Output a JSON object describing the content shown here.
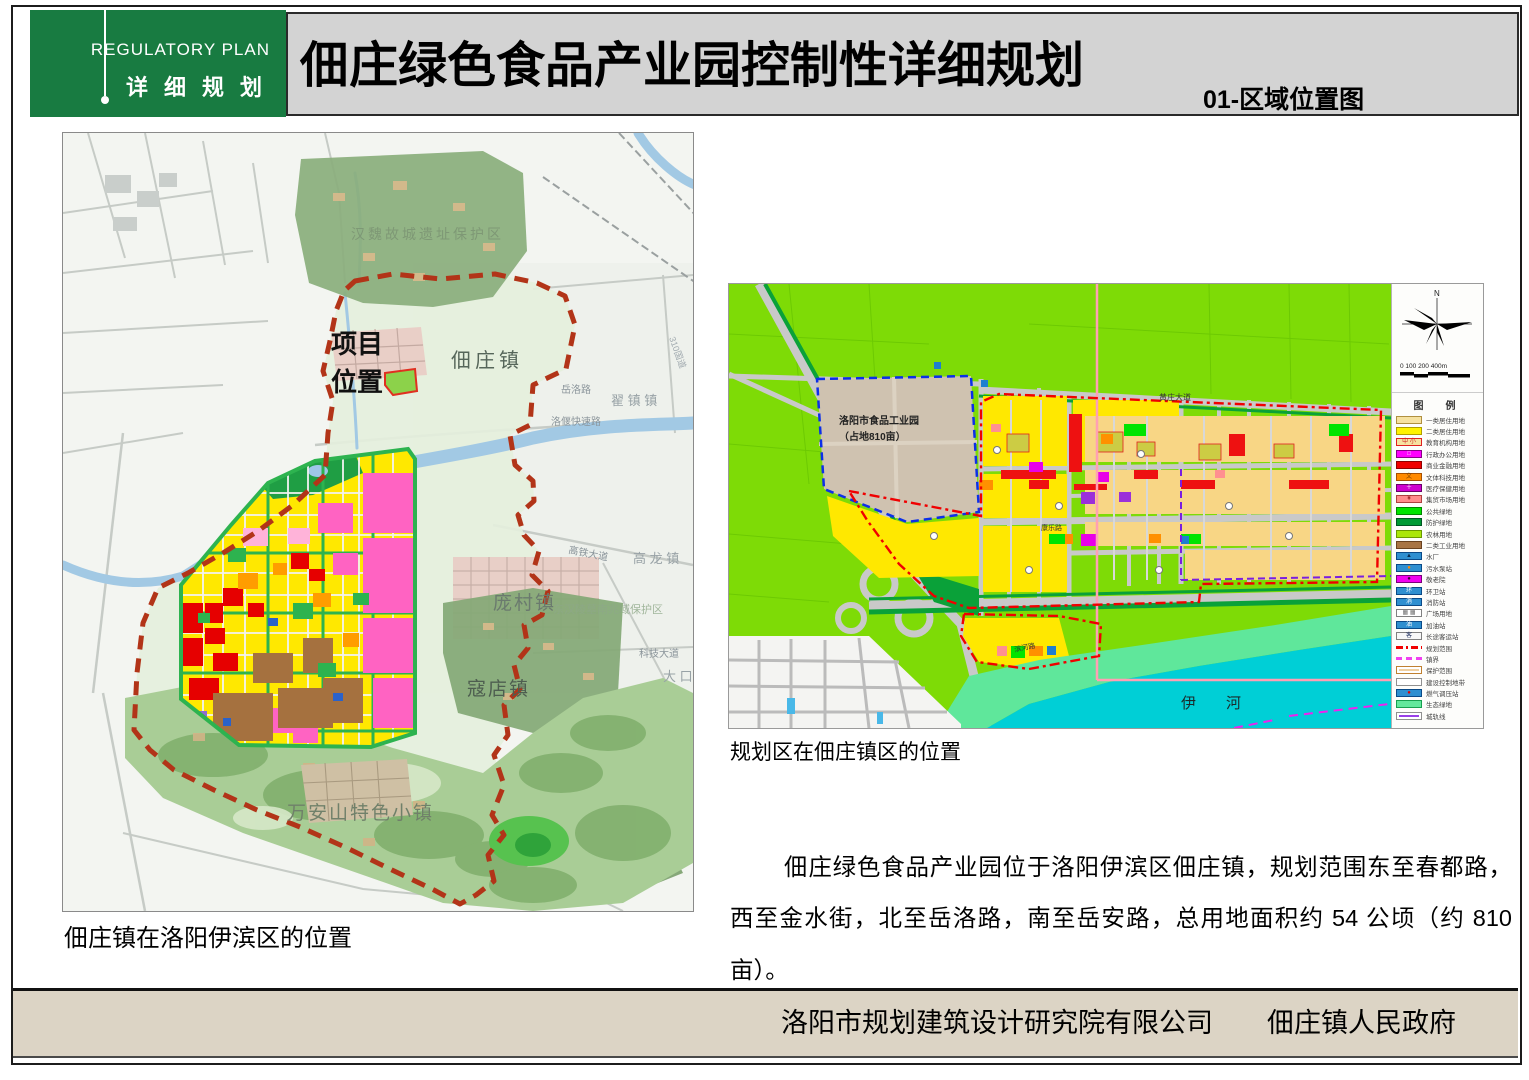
{
  "header": {
    "brand": {
      "line_en": "REGULATORY PLAN",
      "line_zh": "详细规划"
    },
    "title": "佃庄绿色食品产业园控制性详细规划",
    "sheet_label": "01-区域位置图"
  },
  "left_map": {
    "caption": "佃庄镇在洛阳伊滨区的位置",
    "labels": {
      "project_line1": "项目",
      "project_line2": "位置",
      "dianzhuang_town": "佃庄镇",
      "hanwei_reserve": "汉魏故城遗址保护区",
      "zhaizhen_town": "翟 镇 镇",
      "pangcun_town": "庞村镇",
      "gaolong_town": "高 龙 镇",
      "dakou_town": "大 口 镇",
      "koudian_town": "寇店镇",
      "yan": "偃",
      "shi": "师",
      "shi_city": "市",
      "wananshan": "万安山特色小镇",
      "donghan_reserve": "东汉陵墓南兆域保护区",
      "yichuan_county": "伊　川　县",
      "chengzhen_line": "城镇建设区域",
      "road_yueluo": "岳洛路",
      "road_luoyan": "洛偃快速路",
      "road_gaotie": "高铁大道",
      "road_keji": "科技大道",
      "road_g310": "310国道"
    }
  },
  "right_map": {
    "caption": "规划区在佃庄镇区的位置",
    "labels": {
      "industry_park_1": "洛阳市食品工业园",
      "industry_park_2": "（占地810亩）",
      "yi_river": "伊　　河",
      "road_huangzhuang": "黄庄大道",
      "road_kangle": "康乐路",
      "road_binhe": "滨河路"
    },
    "compass_n": "N",
    "scale_text": "0   100  200            400m",
    "legend": {
      "title": "图　例",
      "items": [
        {
          "label": "一类居住用地",
          "kind": "box",
          "fill": "#F6E2A0",
          "border": "#B09040"
        },
        {
          "label": "二类居住用地",
          "kind": "box",
          "fill": "#FFF200",
          "border": "#B0A000"
        },
        {
          "label": "教育机构用地",
          "kind": "box",
          "fill": "#F6E2A0",
          "border": "#E02020",
          "icon": "中 小",
          "iconColor": "#D02020"
        },
        {
          "label": "行政办公用地",
          "kind": "box",
          "fill": "#FF00FF",
          "border": "#880088",
          "icon": "□",
          "iconColor": "#FFFFFF"
        },
        {
          "label": "商业金融用地",
          "kind": "box",
          "fill": "#F00000",
          "border": "#900000"
        },
        {
          "label": "文体科技用地",
          "kind": "box",
          "fill": "#FF8A00",
          "border": "#A85000",
          "icon": "文",
          "iconColor": "#7A4000"
        },
        {
          "label": "医疗保健用地",
          "kind": "box",
          "fill": "#CE00CE",
          "border": "#6A006A",
          "icon": "＋",
          "iconColor": "#FFFFFF"
        },
        {
          "label": "集贸市场用地",
          "kind": "box",
          "fill": "#FF8C8C",
          "border": "#B04040",
          "icon": "¥",
          "iconColor": "#8A1010"
        },
        {
          "label": "公共绿地",
          "kind": "box",
          "fill": "#00E400",
          "border": "#008800"
        },
        {
          "label": "防护绿地",
          "kind": "box",
          "fill": "#009933",
          "border": "#005522"
        },
        {
          "label": "农林用地",
          "kind": "box",
          "fill": "#AAE60A",
          "border": "#6A9A00"
        },
        {
          "label": "二类工业用地",
          "kind": "box",
          "fill": "#A87444",
          "border": "#6A4220"
        },
        {
          "label": "水厂",
          "kind": "box",
          "fill": "#2E8FD0",
          "border": "#0A4A88",
          "icon": "▲",
          "iconColor": "#062A4E"
        },
        {
          "label": "污水泵站",
          "kind": "box",
          "fill": "#2E8FD0",
          "border": "#0A4A88",
          "icon": "●",
          "iconColor": "#FF8800"
        },
        {
          "label": "敬老院",
          "kind": "box",
          "fill": "#F000F0",
          "border": "#7A007A",
          "icon": "●",
          "iconColor": "#3A003A"
        },
        {
          "label": "环卫站",
          "kind": "box",
          "fill": "#2E8FD0",
          "border": "#0A4A88",
          "icon": "环",
          "iconColor": "#FFFFFF"
        },
        {
          "label": "消防站",
          "kind": "box",
          "fill": "#2E8FD0",
          "border": "#0A4A88",
          "icon": "消",
          "iconColor": "#FFFFFF"
        },
        {
          "label": "广场用地",
          "kind": "box",
          "fill": "#FFFFFF",
          "border": "#808080",
          "icon": "▦ ▦",
          "iconColor": "#707070"
        },
        {
          "label": "加油站",
          "kind": "box",
          "fill": "#2E8FD0",
          "border": "#0A4A88",
          "icon": "油",
          "iconColor": "#FFFFFF"
        },
        {
          "label": "长途客运站",
          "kind": "box",
          "fill": "#F8F8F8",
          "border": "#808080",
          "icon": "客",
          "iconColor": "#203060"
        },
        {
          "label": "规划范围",
          "kind": "line",
          "lineColor": "#F00000",
          "lineStyle": "dashdot"
        },
        {
          "label": "镇界",
          "kind": "line",
          "lineColor": "#F040F0",
          "lineStyle": "dash"
        },
        {
          "label": "保护范围",
          "kind": "outline",
          "fill": "#FFFFFF",
          "border": "#C08030",
          "lineColor": "#F0D0A0"
        },
        {
          "label": "建设控制地带",
          "kind": "outline",
          "fill": "#FFFFFF",
          "border": "#909090",
          "lineColor": ""
        },
        {
          "label": "燃气调压站",
          "kind": "box",
          "fill": "#2E8FD0",
          "border": "#0A4A88",
          "icon": "●",
          "iconColor": "#E00000"
        },
        {
          "label": "生态绿地",
          "kind": "box",
          "fill": "#63E89C",
          "border": "#18A050"
        },
        {
          "label": "城轨线",
          "kind": "outline",
          "fill": "#FFFFFF",
          "border": "#909090",
          "lineColor": "#9940E8"
        }
      ]
    }
  },
  "description": "佃庄绿色食品产业园位于洛阳伊滨区佃庄镇，规划范围东至春都路，西至金水街，北至岳洛路，南至岳安路，总用地面积约 54 公顷（约 810 亩）。",
  "footer": {
    "credits": "洛阳市规划建筑设计研究院有限公司　　佃庄镇人民政府"
  }
}
